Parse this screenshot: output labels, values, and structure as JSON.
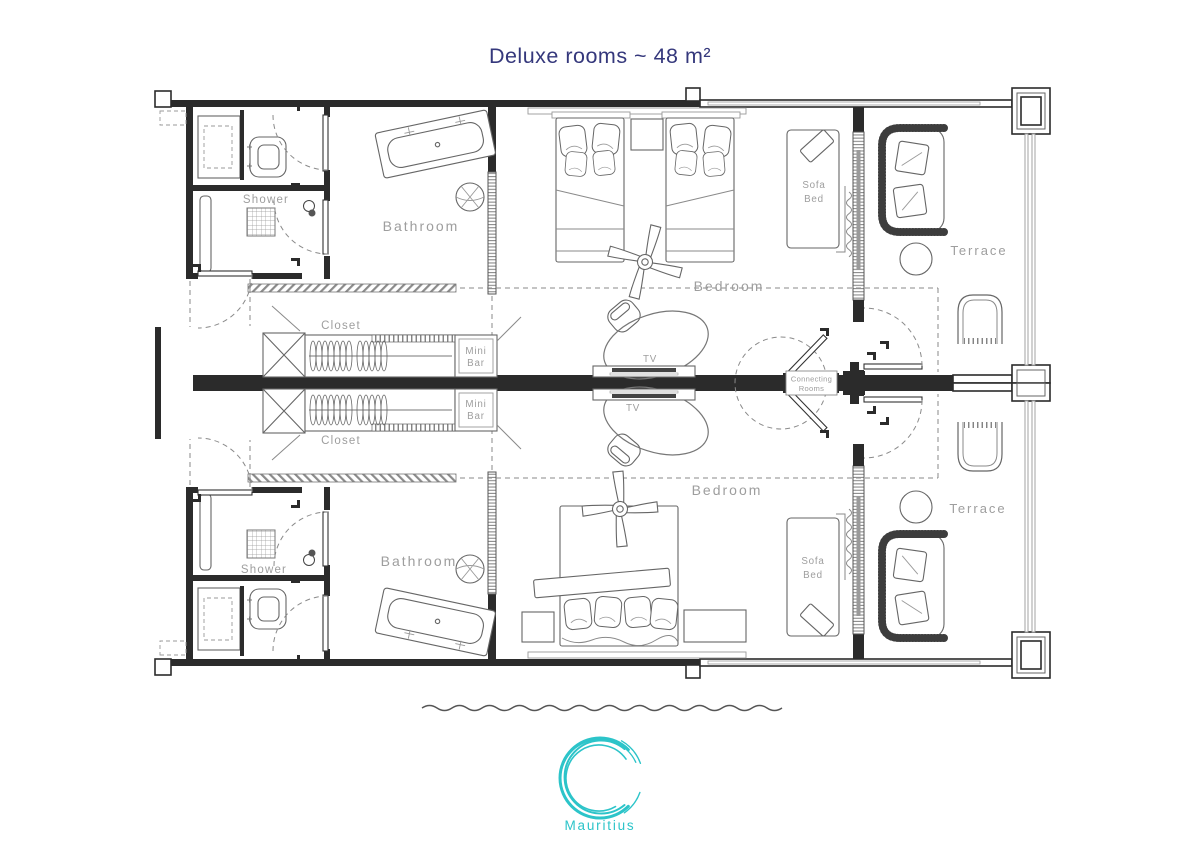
{
  "title": "Deluxe rooms ~ 48 m²",
  "brand": {
    "name": "Mauritius",
    "logo": "c-wave-logo"
  },
  "colors": {
    "title_navy": "#35387c",
    "teal_accent": "#2cc4c9",
    "label_gray": "#9e9e9e",
    "wall_dark": "#2b2b2b"
  },
  "rooms": {
    "top": {
      "bathroom": "Bathroom",
      "shower": "Shower",
      "closet": "Closet",
      "mini_bar_line1": "Mini",
      "mini_bar_line2": "Bar",
      "tv": "TV",
      "bedroom": "Bedroom",
      "sofa_bed_line1": "Sofa",
      "sofa_bed_line2": "Bed",
      "terrace": "Terrace"
    },
    "bottom": {
      "bathroom": "Bathroom",
      "shower": "Shower",
      "closet": "Closet",
      "mini_bar_line1": "Mini",
      "mini_bar_line2": "Bar",
      "tv": "TV",
      "bedroom": "Bedroom",
      "sofa_bed_line1": "Sofa",
      "sofa_bed_line2": "Bed",
      "terrace": "Terrace"
    }
  },
  "connecting_rooms": {
    "line1": "Connecting",
    "line2": "Rooms"
  }
}
